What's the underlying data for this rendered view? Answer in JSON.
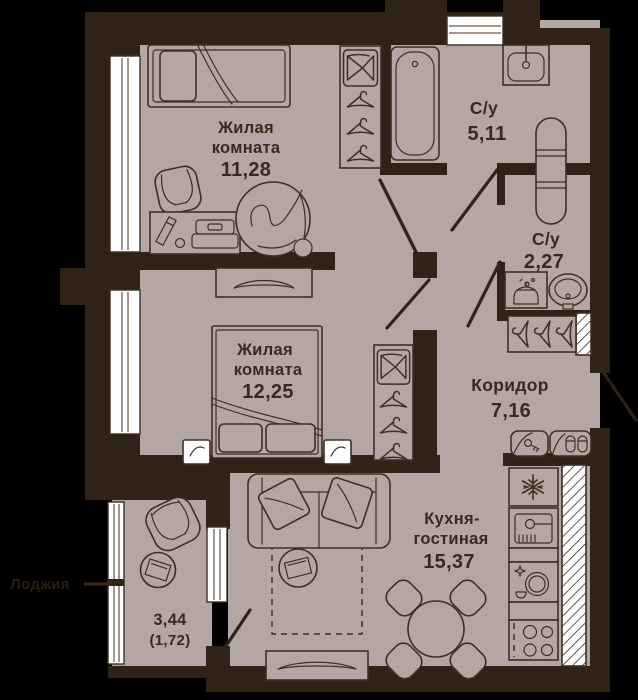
{
  "colors": {
    "bg": "#000000",
    "wall": "#2f2318",
    "floor": "#b4a6a3",
    "line": "#3f2f22",
    "text": "#3a2a1d",
    "white": "#ffffff"
  },
  "rooms": {
    "bedroom1": {
      "name_line1": "Жилая",
      "name_line2": "комната",
      "area": "11,28"
    },
    "bathroom1": {
      "name": "С/у",
      "area": "5,11"
    },
    "bathroom2": {
      "name": "С/у",
      "area": "2,27"
    },
    "bedroom2": {
      "name_line1": "Жилая",
      "name_line2": "комната",
      "area": "12,25"
    },
    "corridor": {
      "name": "Коридор",
      "area": "7,16"
    },
    "kitchen_living": {
      "name_line1": "Кухня-",
      "name_line2": "гостиная",
      "area": "15,37"
    },
    "loggia": {
      "area": "3,44",
      "area_reduced": "(1,72)"
    }
  },
  "edge_label": {
    "text": "Лоджия"
  }
}
